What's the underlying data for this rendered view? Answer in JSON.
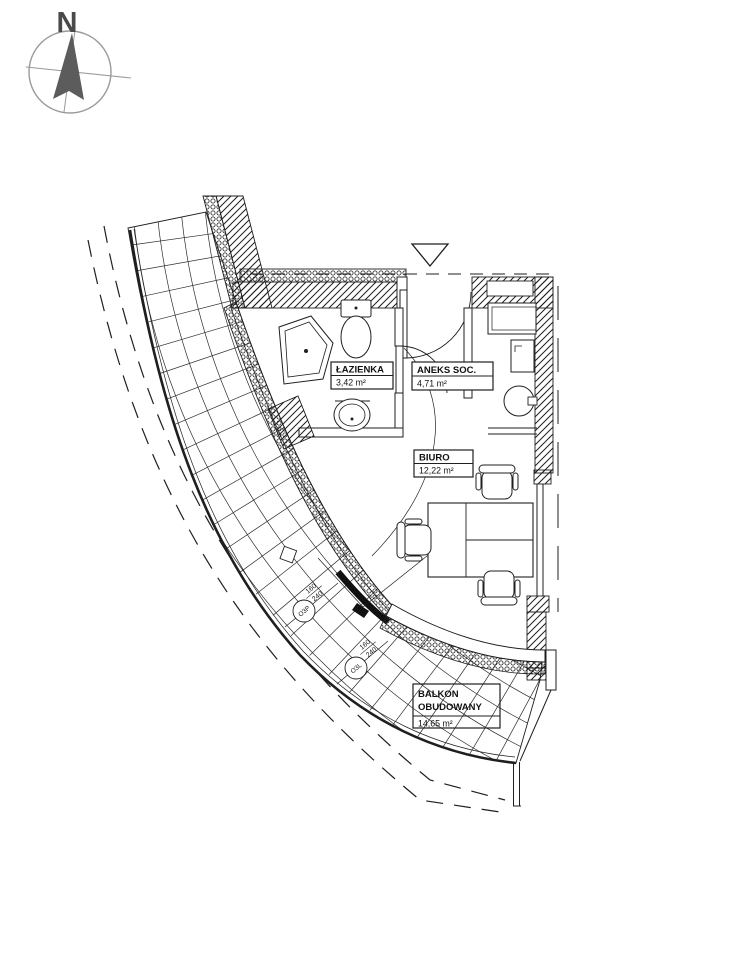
{
  "compass": {
    "north_label": "N"
  },
  "rooms": [
    {
      "name": "ŁAZIENKA",
      "area": "3,42 m²"
    },
    {
      "name": "ANEKS SOC.",
      "area": "4,71 m²"
    },
    {
      "name": "BIURO",
      "area": "12,22 m²"
    },
    {
      "name": "BALKON",
      "name_line2": "OBUDOWANY",
      "area": "14,65 m²"
    }
  ],
  "windows": [
    {
      "code": "O3P",
      "dim_w": "160",
      "dim_h": "240"
    },
    {
      "code": "O3L",
      "dim_w": "160",
      "dim_h": "240"
    }
  ],
  "colors": {
    "ink": "#1f1f1f",
    "compass_gray": "#8f8f8f",
    "arrow_gray": "#5c5c5c"
  }
}
